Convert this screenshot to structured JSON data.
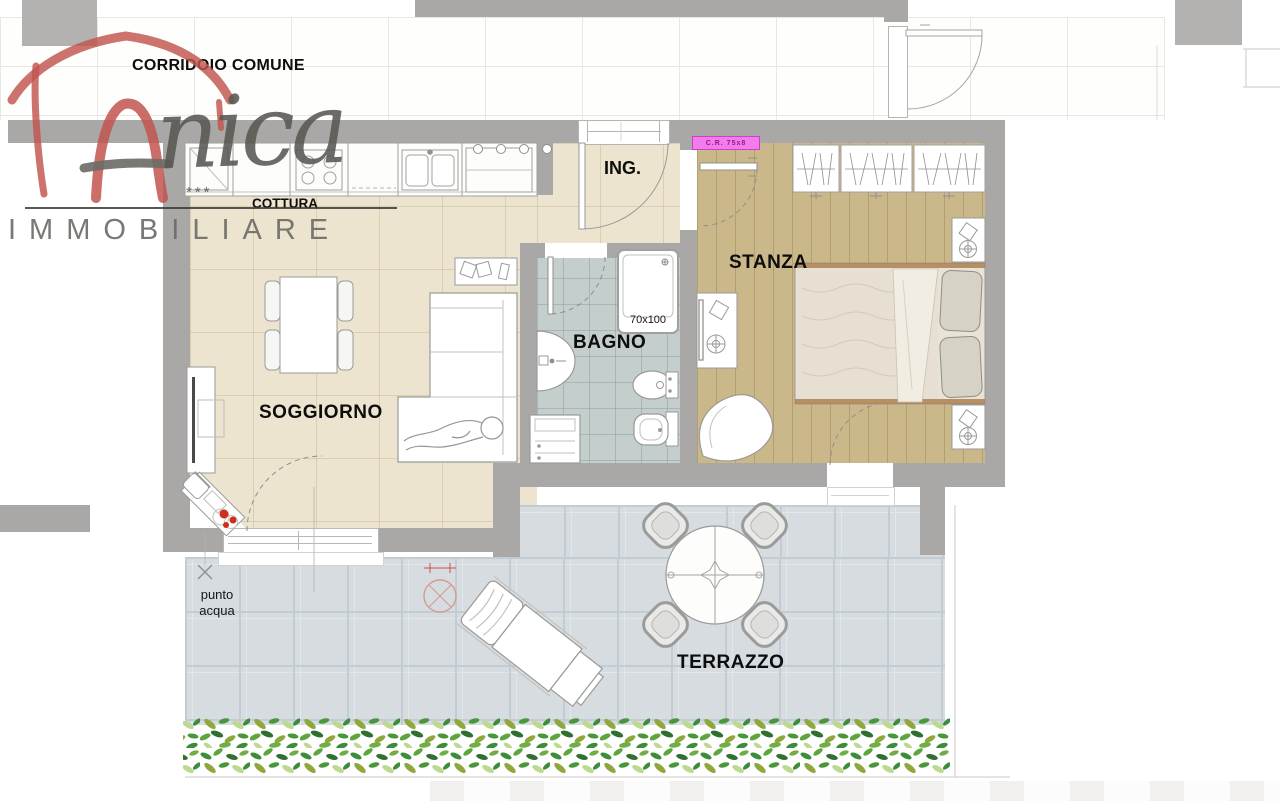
{
  "labels": {
    "corridor": "CORRIDOIO COMUNE",
    "kitchen": "COTTURA",
    "entrance": "ING.",
    "bedroom": "STANZA",
    "bathroom": "BAGNO",
    "living": "SOGGIORNO",
    "terrace": "TERRAZZO"
  },
  "annotations": {
    "shower_size": "70x100",
    "water_point_line1": "punto",
    "water_point_line2": "acqua",
    "roller_box": "C.R. 75x8"
  },
  "logo": {
    "script": "nica",
    "stars": "***",
    "subtitle": "IMMOBILIARE"
  },
  "colors": {
    "wall_gray": "#a9a8a6",
    "living_floor_beige": "#ece4cf",
    "bedroom_floor_tan": "#cbb88a",
    "bathroom_floor_blue": "#c4cecd",
    "terrace_floor_gray": "#d6dce0",
    "logo_red": "#c2544e",
    "logo_gray": "#66645f",
    "roller_box_pink": "#f27cec",
    "hedge_green": "#4f9a3a",
    "flower_red": "#cf2d20"
  },
  "furniture_icons": [
    "kitchen-counter",
    "double-sink",
    "cooktop",
    "dining-table",
    "dining-chair",
    "tv-cabinet",
    "corner-desk",
    "flower-pot",
    "sofa-with-person",
    "wall-shelf",
    "washing-machine",
    "hand-basin",
    "bidet",
    "toilet",
    "shower-tray",
    "wardrobe",
    "double-bed",
    "nightstand",
    "dressing-table",
    "armchair",
    "round-terrace-table",
    "terrace-chair",
    "sun-lounger",
    "hedge",
    "water-point-cross",
    "floor-drain",
    "door-swing-arcs"
  ]
}
